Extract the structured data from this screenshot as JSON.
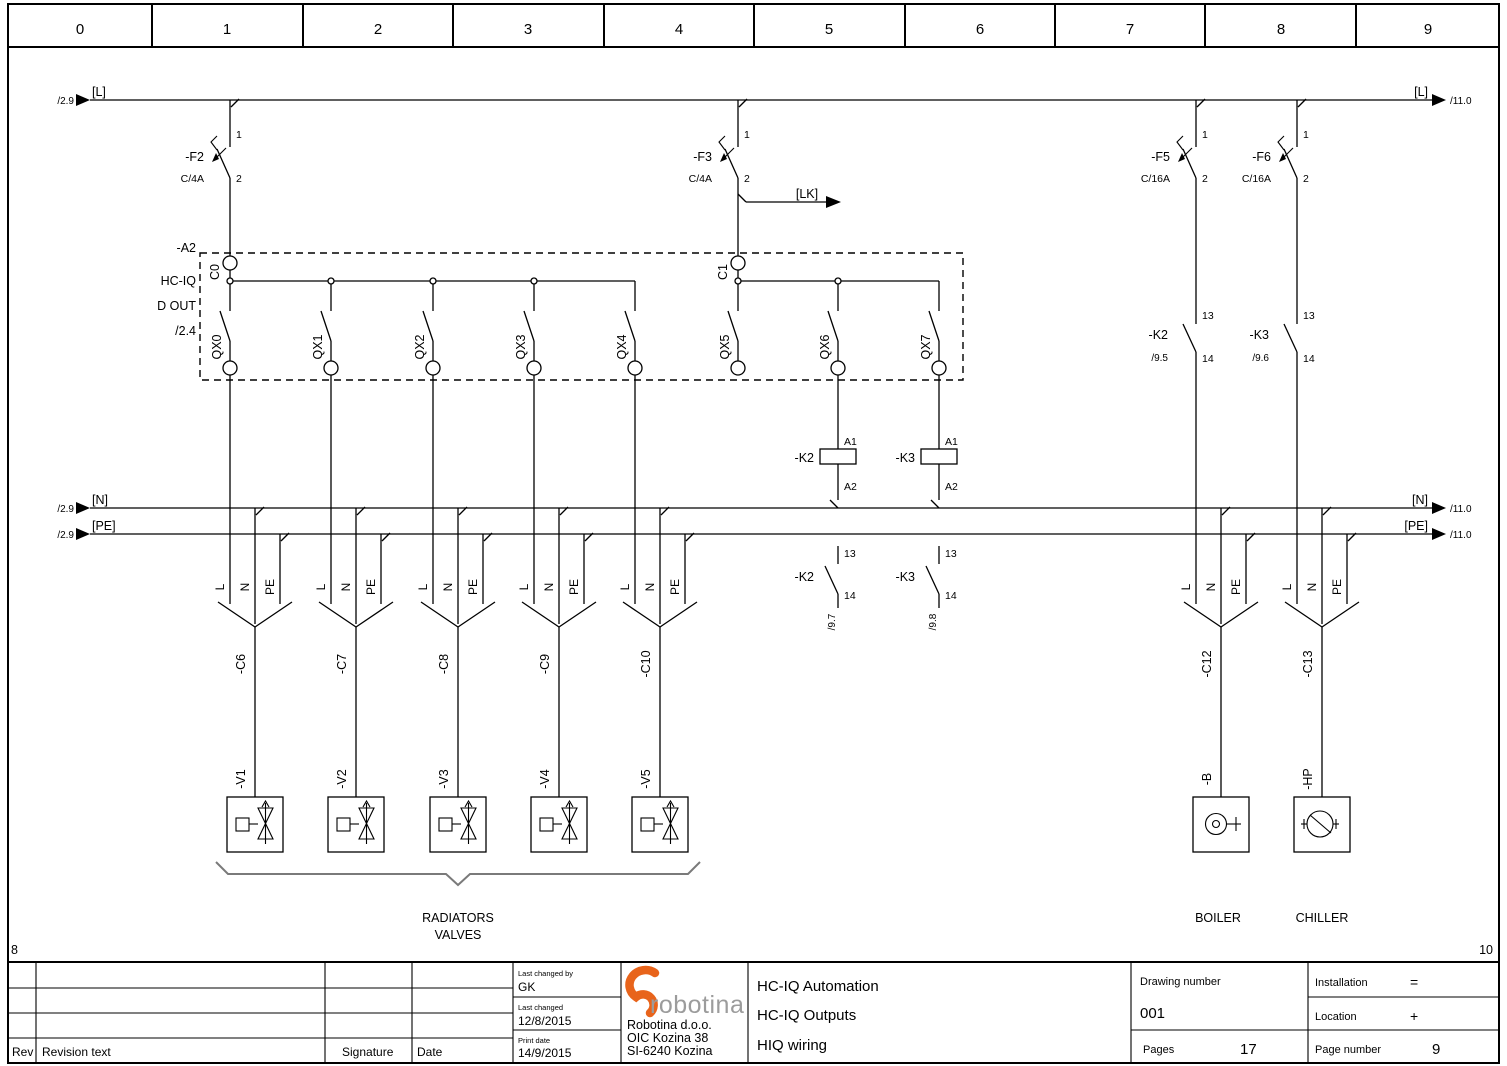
{
  "page": {
    "ruler": [
      "0",
      "1",
      "2",
      "3",
      "4",
      "5",
      "6",
      "7",
      "8",
      "9"
    ],
    "frame": {
      "bottom_left": "8",
      "bottom_right": "10"
    }
  },
  "rails": {
    "l": {
      "label": "[L]",
      "left_ref": "/2.9",
      "right_ref": "/11.0"
    },
    "n": {
      "label": "[N]",
      "left_ref": "/2.9",
      "right_ref": "/11.0"
    },
    "pe": {
      "label": "[PE]",
      "left_ref": "/2.9",
      "right_ref": "/11.0"
    },
    "lk": {
      "label": "[LK]"
    }
  },
  "breakers": [
    {
      "name": "-F2",
      "rating": "C/4A",
      "pin_top": "1",
      "pin_bottom": "2"
    },
    {
      "name": "-F3",
      "rating": "C/4A",
      "pin_top": "1",
      "pin_bottom": "2"
    },
    {
      "name": "-F5",
      "rating": "C/16A",
      "pin_top": "1",
      "pin_bottom": "2"
    },
    {
      "name": "-F6",
      "rating": "C/16A",
      "pin_top": "1",
      "pin_bottom": "2"
    }
  ],
  "module": {
    "name": "-A2",
    "device": "HC-IQ",
    "function": "D OUT",
    "ref": "/2.4",
    "commons": [
      "C0",
      "C1"
    ],
    "outputs": [
      "QX0",
      "QX1",
      "QX2",
      "QX3",
      "QX4",
      "QX5",
      "QX6",
      "QX7"
    ]
  },
  "coils": [
    {
      "name": "-K2",
      "a1": "A1",
      "a2": "A2"
    },
    {
      "name": "-K3",
      "a1": "A1",
      "a2": "A2"
    }
  ],
  "power_contacts": [
    {
      "name": "-K2",
      "ref": "/9.5",
      "t13": "13",
      "t14": "14"
    },
    {
      "name": "-K3",
      "ref": "/9.6",
      "t13": "13",
      "t14": "14"
    }
  ],
  "aux_contacts": [
    {
      "name": "-K2",
      "ref": "/9.7",
      "t13": "13",
      "t14": "14"
    },
    {
      "name": "-K3",
      "ref": "/9.8",
      "t13": "13",
      "t14": "14"
    }
  ],
  "cables": [
    {
      "name": "-C6",
      "cores": [
        "L",
        "N",
        "PE"
      ]
    },
    {
      "name": "-C7",
      "cores": [
        "L",
        "N",
        "PE"
      ]
    },
    {
      "name": "-C8",
      "cores": [
        "L",
        "N",
        "PE"
      ]
    },
    {
      "name": "-C9",
      "cores": [
        "L",
        "N",
        "PE"
      ]
    },
    {
      "name": "-C10",
      "cores": [
        "L",
        "N",
        "PE"
      ]
    },
    {
      "name": "-C12",
      "cores": [
        "L",
        "N",
        "PE"
      ]
    },
    {
      "name": "-C13",
      "cores": [
        "L",
        "N",
        "PE"
      ]
    }
  ],
  "loads": [
    {
      "name": "-V1"
    },
    {
      "name": "-V2"
    },
    {
      "name": "-V3"
    },
    {
      "name": "-V4"
    },
    {
      "name": "-V5"
    },
    {
      "name": "-B"
    },
    {
      "name": "-HP"
    }
  ],
  "captions": {
    "radiators_line1": "RADIATORS",
    "radiators_line2": "VALVES",
    "boiler": "BOILER",
    "chiller": "CHILLER"
  },
  "title_block": {
    "revision": {
      "rev": "Rev",
      "text": "Revision text",
      "signature": "Signature",
      "date": "Date"
    },
    "changed": {
      "by_label": "Last changed by",
      "by": "GK",
      "last_label": "Last changed",
      "last": "12/8/2015",
      "print_label": "Print date",
      "print": "14/9/2015"
    },
    "company": {
      "logo": "robotina",
      "line1": "Robotina d.o.o.",
      "line2": "OIC Kozina 38",
      "line3": "SI-6240 Kozina"
    },
    "titles": {
      "line1": "HC-IQ Automation",
      "line2": "HC-IQ Outputs",
      "line3": "HIQ wiring"
    },
    "drawing": {
      "label": "Drawing number",
      "number": "001",
      "pages_label": "Pages",
      "pages": "17"
    },
    "loc": {
      "installation_label": "Installation",
      "installation": "=",
      "location_label": "Location",
      "location": "+",
      "page_label": "Page number",
      "page": "9"
    }
  },
  "colors": {
    "logo_orange": "#E8641B",
    "logo_gray": "#9C9C9C",
    "line": "#000000"
  }
}
